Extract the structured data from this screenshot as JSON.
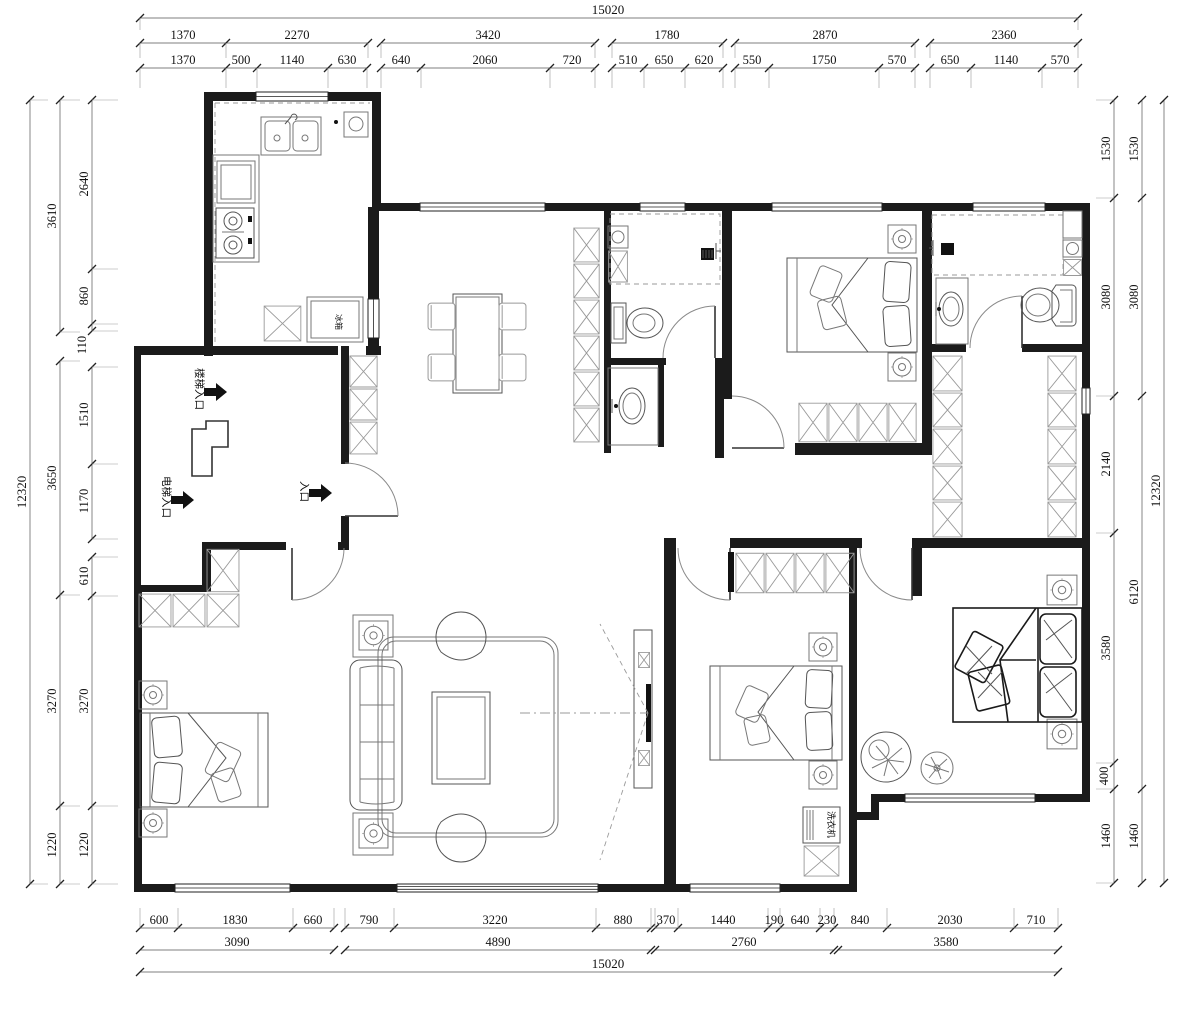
{
  "title": "apartment-floor-plan",
  "labels": {
    "stair_entrance": "楼梯入口",
    "elevator_entrance": "电梯入口",
    "entrance": "入口",
    "washing_machine": "洗衣机",
    "fridge": "冰箱"
  },
  "dims": {
    "top_total": "15020",
    "top_groups": [
      "1370",
      "2270",
      "3420",
      "1780",
      "2870",
      "2360"
    ],
    "top_detail": [
      "1370",
      "500",
      "1140",
      "630",
      "640",
      "2060",
      "720",
      "510",
      "650",
      "620",
      "550",
      "1750",
      "570",
      "650",
      "1140",
      "570"
    ],
    "bottom_total": "15020",
    "bottom_groups": [
      "3090",
      "4890",
      "2760",
      "3580"
    ],
    "bottom_detail": [
      "600",
      "1830",
      "660",
      "790",
      "3220",
      "880",
      "370",
      "1440",
      "190",
      "640",
      "230",
      "840",
      "2030",
      "710"
    ],
    "left_total": "12320",
    "left_mid": [
      "3610",
      "3650",
      "3270",
      "1220"
    ],
    "left_detail": [
      "2640",
      "860",
      "110",
      "1510",
      "1170",
      "610",
      "3270",
      "1220"
    ],
    "right_total": "12320",
    "right_mid": [
      "1530",
      "3080",
      "6120",
      "1460"
    ],
    "right_detail": [
      "1530",
      "3080",
      "2140",
      "3580",
      "400",
      "1460"
    ]
  }
}
